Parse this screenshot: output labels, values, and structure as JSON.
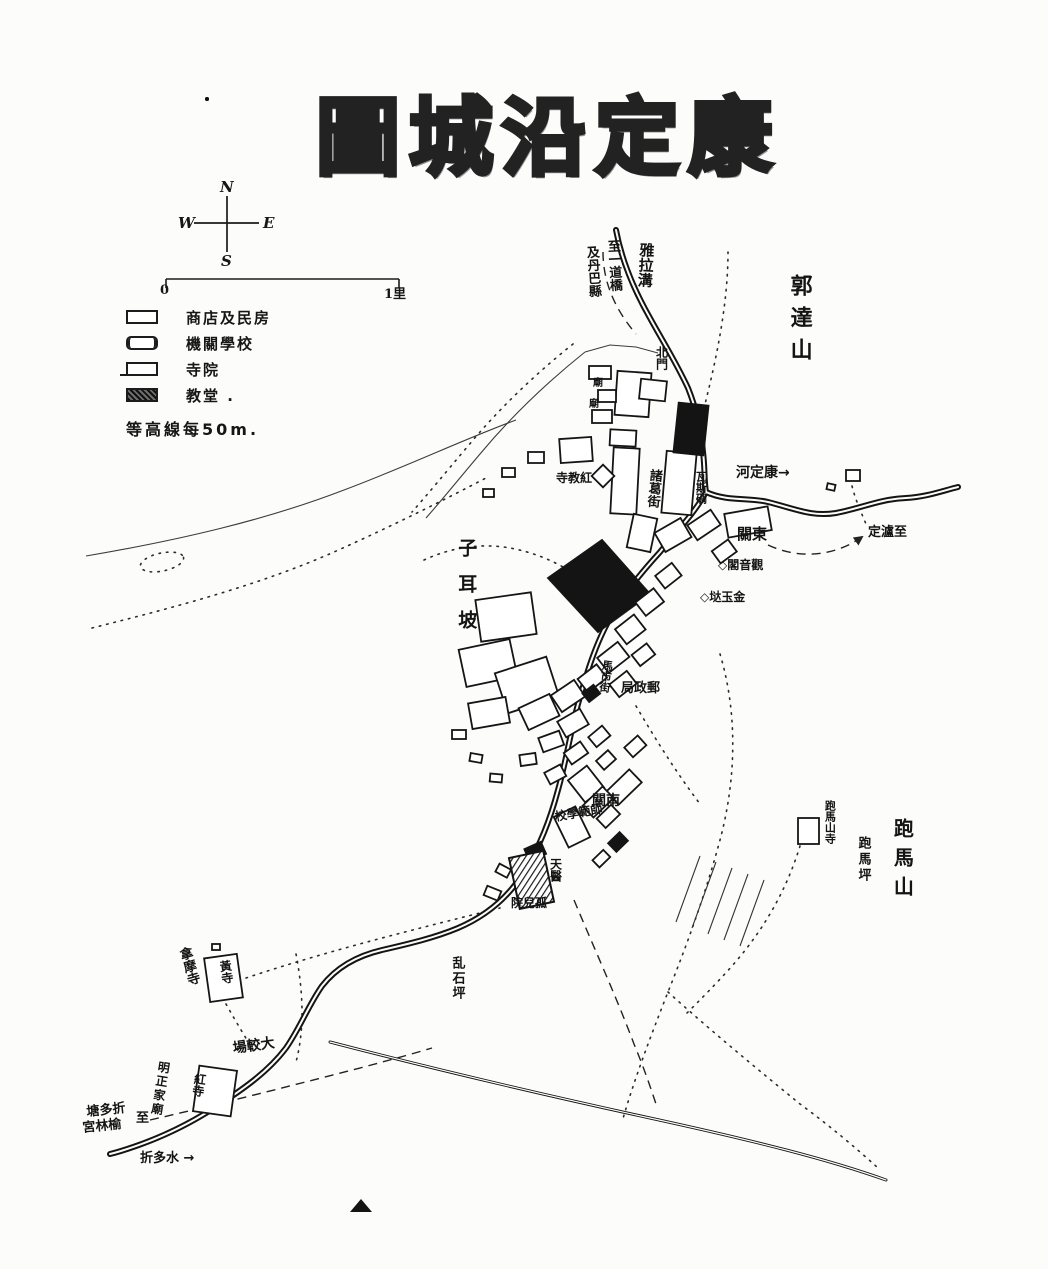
{
  "title": {
    "text": "圖城沿定康"
  },
  "compass": {
    "north": "N",
    "east": "E",
    "south": "S",
    "west": "W"
  },
  "scale_bar": {
    "start": "0",
    "end": "1里"
  },
  "legend": {
    "items": [
      {
        "id": "shops",
        "label": "商店及民房"
      },
      {
        "id": "institutions",
        "label": "機關學校"
      },
      {
        "id": "temples",
        "label": "寺院"
      },
      {
        "id": "churches",
        "label": "教堂 ."
      }
    ],
    "contour_note": "等高線每50m."
  },
  "colors": {
    "ink": "#161616",
    "paper": "#fcfcfa",
    "title_fill": "#8a8a8a"
  },
  "map": {
    "labels": [
      {
        "id": "yala-gou",
        "text": "雅拉溝",
        "x": 638,
        "y": 242,
        "size": 15,
        "vertical": true,
        "rot": 3
      },
      {
        "id": "to-yidao-bridge",
        "text": "至一道橋",
        "x": 604,
        "y": 240,
        "size": 13,
        "vertical": true,
        "rot": -3
      },
      {
        "id": "to-danba-county",
        "text": "及丹巴縣",
        "x": 583,
        "y": 246,
        "size": 13,
        "vertical": true,
        "rot": -3
      },
      {
        "id": "guoda-mountain",
        "text": "郭達山",
        "x": 786,
        "y": 274,
        "size": 22,
        "vertical": true,
        "ls": 10
      },
      {
        "id": "north-gate",
        "text": "北門",
        "x": 654,
        "y": 346,
        "size": 12,
        "vertical": true
      },
      {
        "id": "temple-mark-1",
        "text": "廟",
        "x": 593,
        "y": 378,
        "size": 10
      },
      {
        "id": "temple-mark-2",
        "text": "廟",
        "x": 589,
        "y": 399,
        "size": 10
      },
      {
        "id": "zhuge-street",
        "text": "諸葛街",
        "x": 647,
        "y": 468,
        "size": 13,
        "vertical": true,
        "rot": 5
      },
      {
        "id": "gas-blockhouse",
        "text": "瓦斯碉",
        "x": 694,
        "y": 471,
        "size": 11,
        "vertical": true
      },
      {
        "id": "red-sect-temple",
        "text": "寺教紅",
        "x": 556,
        "y": 472,
        "size": 12
      },
      {
        "id": "kangding-river",
        "text": "河定康→",
        "x": 736,
        "y": 466,
        "size": 14
      },
      {
        "id": "to-luding",
        "text": "定瀘至",
        "x": 868,
        "y": 526,
        "size": 13
      },
      {
        "id": "east-gate",
        "text": "關東",
        "x": 737,
        "y": 526,
        "size": 15
      },
      {
        "id": "guanyin-pavilion",
        "text": "◇閣音觀",
        "x": 718,
        "y": 559,
        "size": 12
      },
      {
        "id": "jinyu-da",
        "text": "◇垯玉金",
        "x": 700,
        "y": 591,
        "size": 12
      },
      {
        "id": "zier-slope",
        "text": "子耳坡",
        "x": 455,
        "y": 538,
        "size": 19,
        "vertical": true,
        "ls": 17
      },
      {
        "id": "post-office",
        "text": "局政郵",
        "x": 621,
        "y": 682,
        "size": 13
      },
      {
        "id": "horse-market-street",
        "text": "馬市街",
        "x": 601,
        "y": 659,
        "size": 11,
        "vertical": true,
        "rot": 7
      },
      {
        "id": "south-gate",
        "text": "關南",
        "x": 592,
        "y": 794,
        "size": 14
      },
      {
        "id": "normal-school",
        "text": "校學範師",
        "x": 554,
        "y": 811,
        "size": 12,
        "rot": -10
      },
      {
        "id": "catholic-hospital",
        "text": "天醫",
        "x": 548,
        "y": 858,
        "size": 12,
        "vertical": true
      },
      {
        "id": "orphanage",
        "text": "院兒孤",
        "x": 511,
        "y": 897,
        "size": 12
      },
      {
        "id": "paoma-temple",
        "text": "跑馬山寺",
        "x": 823,
        "y": 800,
        "size": 11,
        "vertical": true
      },
      {
        "id": "paoma-ping",
        "text": "跑馬坪",
        "x": 855,
        "y": 836,
        "size": 13,
        "vertical": true,
        "ls": 3
      },
      {
        "id": "paoma-mountain",
        "text": "跑馬山",
        "x": 891,
        "y": 818,
        "size": 20,
        "vertical": true,
        "ls": 9
      },
      {
        "id": "luanshiping",
        "text": "乱石坪",
        "x": 449,
        "y": 956,
        "size": 13,
        "vertical": true,
        "ls": 2
      },
      {
        "id": "namo-temple",
        "text": "拿摩寺",
        "x": 175,
        "y": 950,
        "size": 13,
        "vertical": true,
        "rot": -16
      },
      {
        "id": "yellow-temple",
        "text": "黃寺",
        "x": 217,
        "y": 961,
        "size": 12,
        "vertical": true,
        "rot": -8
      },
      {
        "id": "parade-ground",
        "text": "場較大",
        "x": 232,
        "y": 1042,
        "size": 14,
        "rot": -8
      },
      {
        "id": "mingzheng-family-temple",
        "text": "明正家廟",
        "x": 157,
        "y": 1060,
        "size": 12,
        "vertical": true,
        "rot": 9,
        "ls": 2
      },
      {
        "id": "red-temple",
        "text": "紅寺",
        "x": 193,
        "y": 1072,
        "size": 12,
        "vertical": true,
        "rot": 8
      },
      {
        "id": "to-zheduotang",
        "text": "塘多折",
        "x": 86,
        "y": 1106,
        "size": 13,
        "rot": -6
      },
      {
        "id": "to-zheduotang-zhi",
        "text": "至",
        "x": 136,
        "y": 1112,
        "size": 13
      },
      {
        "id": "yulin-palace",
        "text": "宮林榆",
        "x": 82,
        "y": 1122,
        "size": 13,
        "rot": -6
      },
      {
        "id": "zheduo-river",
        "text": "折多水 →",
        "x": 140,
        "y": 1152,
        "size": 13
      }
    ]
  }
}
